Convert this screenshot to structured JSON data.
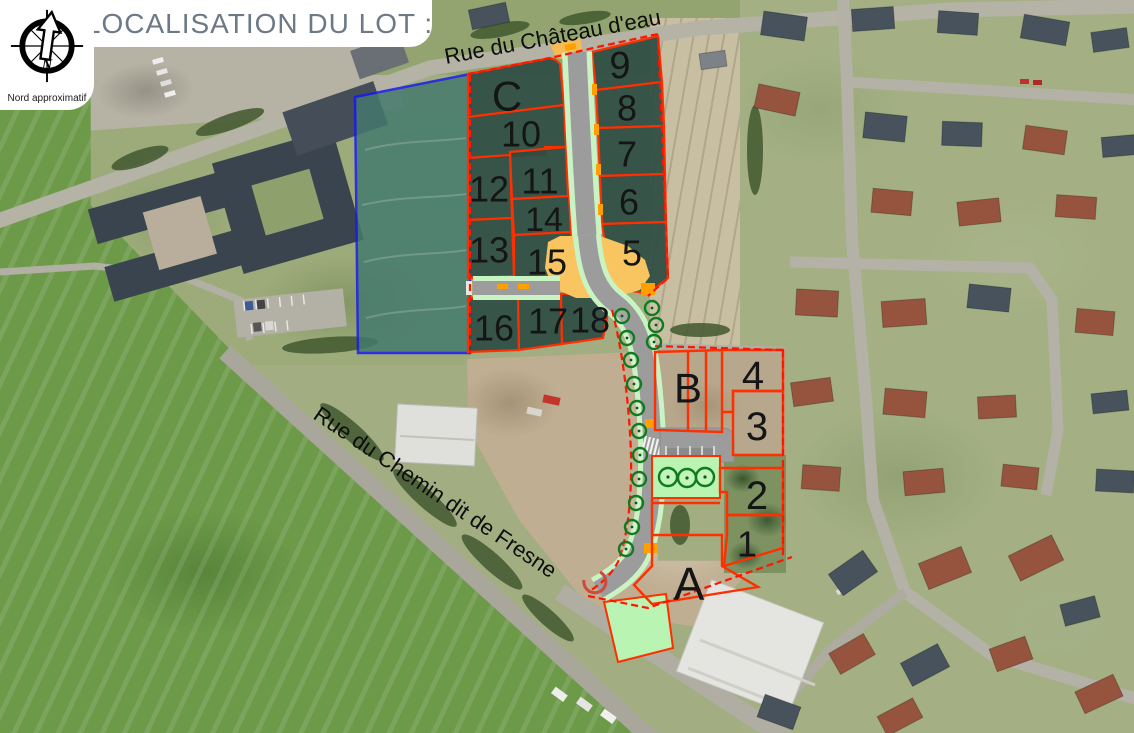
{
  "header": {
    "title": "LOCALISATION DU LOT :",
    "compass": {
      "label": "Nord approximatif",
      "icon": "compass-rose-icon"
    }
  },
  "map": {
    "street_labels": [
      {
        "name": "Rue du Château d'eau"
      },
      {
        "name": "Rue du Chemin dit de Fresne"
      }
    ],
    "lot_labels": [
      {
        "label": "C",
        "x": 507,
        "y": 96,
        "size": 42
      },
      {
        "label": "9",
        "x": 620,
        "y": 66,
        "size": 38
      },
      {
        "label": "10",
        "x": 521,
        "y": 134,
        "size": 36
      },
      {
        "label": "8",
        "x": 627,
        "y": 108,
        "size": 36
      },
      {
        "label": "12",
        "x": 489,
        "y": 189,
        "size": 36
      },
      {
        "label": "11",
        "x": 540,
        "y": 181,
        "size": 36
      },
      {
        "label": "7",
        "x": 627,
        "y": 154,
        "size": 36
      },
      {
        "label": "14",
        "x": 544,
        "y": 220,
        "size": 34
      },
      {
        "label": "6",
        "x": 629,
        "y": 202,
        "size": 36
      },
      {
        "label": "13",
        "x": 489,
        "y": 250,
        "size": 36
      },
      {
        "label": "15",
        "x": 547,
        "y": 262,
        "size": 36
      },
      {
        "label": "5",
        "x": 632,
        "y": 253,
        "size": 36
      },
      {
        "label": "16",
        "x": 494,
        "y": 328,
        "size": 36
      },
      {
        "label": "17",
        "x": 548,
        "y": 321,
        "size": 36
      },
      {
        "label": "18",
        "x": 590,
        "y": 320,
        "size": 36
      },
      {
        "label": "B",
        "x": 688,
        "y": 388,
        "size": 42
      },
      {
        "label": "4",
        "x": 753,
        "y": 376,
        "size": 40
      },
      {
        "label": "3",
        "x": 757,
        "y": 427,
        "size": 40
      },
      {
        "label": "2",
        "x": 757,
        "y": 496,
        "size": 40
      },
      {
        "label": "1",
        "x": 747,
        "y": 544,
        "size": 36
      },
      {
        "label": "A",
        "x": 689,
        "y": 584,
        "size": 46
      }
    ],
    "legend_colors": {
      "lot_boundary_red": "#ff2f00",
      "perimeter_dashed_red": "#ff1500",
      "study_area_blue": "#1a1aee",
      "lot_fill_green": "#2d4c42",
      "road_gray": "#9c9c9c",
      "verge_green": "#c9f3c2",
      "plaza_orange": "#f8c561",
      "marking_orange": "#ff9f00",
      "green_space": "#baf4b3",
      "tree_green": "#117a1f"
    }
  }
}
